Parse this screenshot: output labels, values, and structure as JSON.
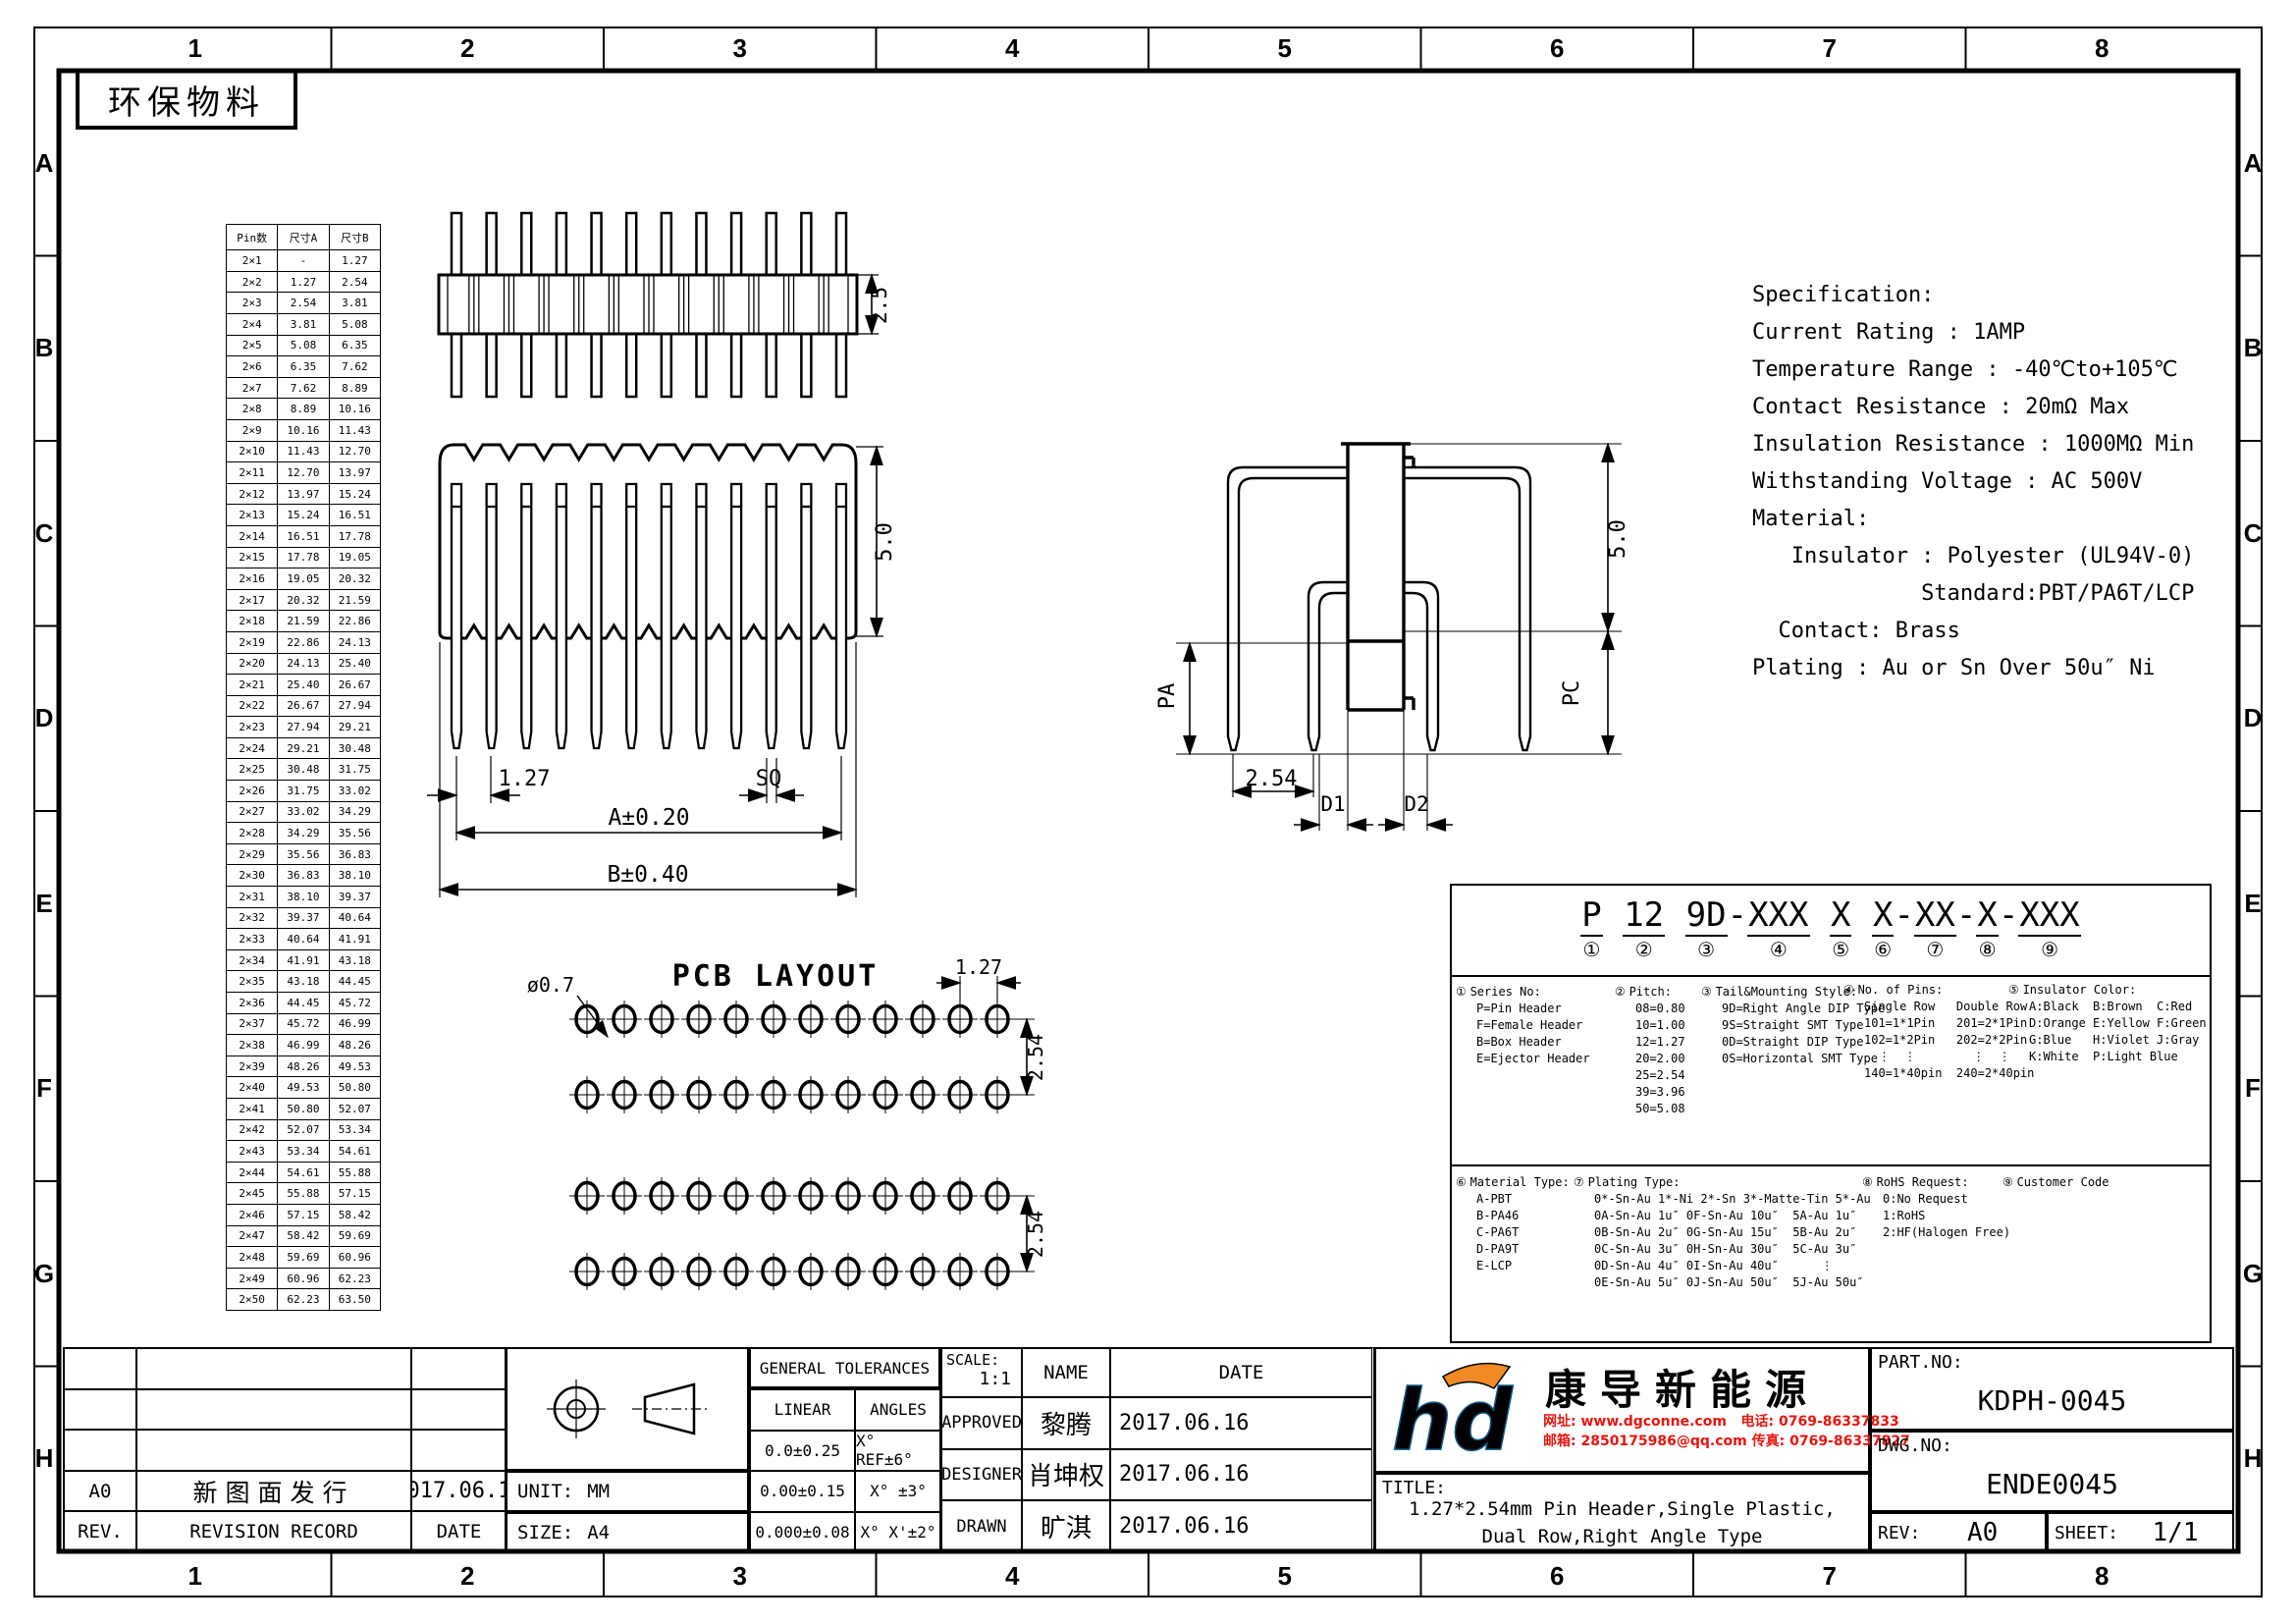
{
  "sheet": {
    "eco_label": "环保物料",
    "col_labels": [
      "1",
      "2",
      "3",
      "4",
      "5",
      "6",
      "7",
      "8"
    ],
    "row_labels": [
      "A",
      "B",
      "C",
      "D",
      "E",
      "F",
      "G",
      "H"
    ]
  },
  "pin_table": {
    "headers": [
      "Pin数",
      "尺寸A",
      "尺寸B"
    ],
    "rows": [
      [
        "2×1",
        "-",
        "1.27"
      ],
      [
        "2×2",
        "1.27",
        "2.54"
      ],
      [
        "2×3",
        "2.54",
        "3.81"
      ],
      [
        "2×4",
        "3.81",
        "5.08"
      ],
      [
        "2×5",
        "5.08",
        "6.35"
      ],
      [
        "2×6",
        "6.35",
        "7.62"
      ],
      [
        "2×7",
        "7.62",
        "8.89"
      ],
      [
        "2×8",
        "8.89",
        "10.16"
      ],
      [
        "2×9",
        "10.16",
        "11.43"
      ],
      [
        "2×10",
        "11.43",
        "12.70"
      ],
      [
        "2×11",
        "12.70",
        "13.97"
      ],
      [
        "2×12",
        "13.97",
        "15.24"
      ],
      [
        "2×13",
        "15.24",
        "16.51"
      ],
      [
        "2×14",
        "16.51",
        "17.78"
      ],
      [
        "2×15",
        "17.78",
        "19.05"
      ],
      [
        "2×16",
        "19.05",
        "20.32"
      ],
      [
        "2×17",
        "20.32",
        "21.59"
      ],
      [
        "2×18",
        "21.59",
        "22.86"
      ],
      [
        "2×19",
        "22.86",
        "24.13"
      ],
      [
        "2×20",
        "24.13",
        "25.40"
      ],
      [
        "2×21",
        "25.40",
        "26.67"
      ],
      [
        "2×22",
        "26.67",
        "27.94"
      ],
      [
        "2×23",
        "27.94",
        "29.21"
      ],
      [
        "2×24",
        "29.21",
        "30.48"
      ],
      [
        "2×25",
        "30.48",
        "31.75"
      ],
      [
        "2×26",
        "31.75",
        "33.02"
      ],
      [
        "2×27",
        "33.02",
        "34.29"
      ],
      [
        "2×28",
        "34.29",
        "35.56"
      ],
      [
        "2×29",
        "35.56",
        "36.83"
      ],
      [
        "2×30",
        "36.83",
        "38.10"
      ],
      [
        "2×31",
        "38.10",
        "39.37"
      ],
      [
        "2×32",
        "39.37",
        "40.64"
      ],
      [
        "2×33",
        "40.64",
        "41.91"
      ],
      [
        "2×34",
        "41.91",
        "43.18"
      ],
      [
        "2×35",
        "43.18",
        "44.45"
      ],
      [
        "2×36",
        "44.45",
        "45.72"
      ],
      [
        "2×37",
        "45.72",
        "46.99"
      ],
      [
        "2×38",
        "46.99",
        "48.26"
      ],
      [
        "2×39",
        "48.26",
        "49.53"
      ],
      [
        "2×40",
        "49.53",
        "50.80"
      ],
      [
        "2×41",
        "50.80",
        "52.07"
      ],
      [
        "2×42",
        "52.07",
        "53.34"
      ],
      [
        "2×43",
        "53.34",
        "54.61"
      ],
      [
        "2×44",
        "54.61",
        "55.88"
      ],
      [
        "2×45",
        "55.88",
        "57.15"
      ],
      [
        "2×46",
        "57.15",
        "58.42"
      ],
      [
        "2×47",
        "58.42",
        "59.69"
      ],
      [
        "2×48",
        "59.69",
        "60.96"
      ],
      [
        "2×49",
        "60.96",
        "62.23"
      ],
      [
        "2×50",
        "62.23",
        "63.50"
      ]
    ]
  },
  "spec": {
    "lines": [
      "Specification:",
      "Current Rating : 1AMP",
      "Temperature Range : -40℃to+105℃",
      "Contact Resistance : 20mΩ Max",
      "Insulation Resistance : 1000MΩ Min",
      "Withstanding Voltage : AC 500V",
      "Material:",
      "   Insulator : Polyester (UL94V-0)",
      "             Standard:PBT/PA6T/LCP",
      "  Contact: Brass",
      "Plating : Au or Sn Over 50u″ Ni"
    ]
  },
  "views": {
    "top": {
      "pin_count": 12,
      "dim_height": "2.5"
    },
    "front": {
      "pin_count": 12,
      "dim_h": "5.0",
      "dim_pitch": "1.27",
      "dim_sq": "SQ",
      "dim_a": "A±0.20",
      "dim_b": "B±0.40"
    },
    "side": {
      "dim_h": "5.0",
      "dim_pa": "PA",
      "dim_pc": "PC",
      "dim_pitch": "2.54",
      "dim_d1": "D1",
      "dim_d2": "D2"
    },
    "pcb": {
      "title": "PCB LAYOUT",
      "hole_label": "ø0.7",
      "cols": 12,
      "rows": 4,
      "dim_pitch": "1.27",
      "dim_row_top": "2.54",
      "dim_row_bottom": "2.54"
    }
  },
  "part_code": {
    "segments": [
      {
        "text": "P",
        "num": "①"
      },
      {
        "text": "12",
        "num": "②"
      },
      {
        "text": "9D",
        "num": "③"
      },
      {
        "text": "XXX",
        "num": "④"
      },
      {
        "text": "X",
        "num": "⑤"
      },
      {
        "text": "X",
        "num": "⑥"
      },
      {
        "text": "XX",
        "num": "⑦"
      },
      {
        "text": "X",
        "num": "⑧"
      },
      {
        "text": "XXX",
        "num": "⑨"
      }
    ],
    "separators": [
      "",
      " ",
      " ",
      "-",
      " ",
      " ",
      "-",
      "-",
      "-"
    ],
    "sections_top": [
      {
        "num": "①",
        "title": "Series No:",
        "lines": [
          "P=Pin Header",
          "F=Female Header",
          "B=Box Header",
          "E=Ejector Header"
        ]
      },
      {
        "num": "②",
        "title": "Pitch:",
        "lines": [
          "08=0.80",
          "10=1.00",
          "12=1.27",
          "20=2.00",
          "25=2.54",
          "39=3.96",
          "50=5.08"
        ]
      },
      {
        "num": "③",
        "title": "Tail&Mounting Style:",
        "lines": [
          "9D=Right Angle DIP Type",
          "9S=Straight SMT Type",
          "0D=Straight DIP Type",
          "0S=Horizontal SMT Type"
        ]
      },
      {
        "num": "④",
        "title": "No. of Pins:",
        "lines": [
          "Single Row   Double Row",
          "101=1*1Pin   201=2*1Pin",
          "102=1*2Pin   202=2*2Pin",
          "  ⋮  ⋮        ⋮  ⋮",
          "140=1*40pin  240=2*40pin"
        ]
      },
      {
        "num": "⑤",
        "title": "Insulator Color:",
        "lines": [
          "A:Black  B:Brown  C:Red",
          "D:Orange E:Yellow F:Green",
          "G:Blue   H:Violet J:Gray",
          "K:White  P:Light Blue"
        ]
      }
    ],
    "sections_bottom": [
      {
        "num": "⑥",
        "title": "Material Type:",
        "lines": [
          "A-PBT",
          "B-PA46",
          "C-PA6T",
          "D-PA9T",
          "E-LCP"
        ]
      },
      {
        "num": "⑦",
        "title": "Plating Type:",
        "lines": [
          "0*-Sn-Au 1*-Ni 2*-Sn 3*-Matte-Tin 5*-Au",
          "0A-Sn-Au 1u″ 0F-Sn-Au 10u″  5A-Au 1u″",
          "0B-Sn-Au 2u″ 0G-Sn-Au 15u″  5B-Au 2u″",
          "0C-Sn-Au 3u″ 0H-Sn-Au 30u″  5C-Au 3u″",
          "0D-Sn-Au 4u″ 0I-Sn-Au 40u″      ⋮",
          "0E-Sn-Au 5u″ 0J-Sn-Au 50u″  5J-Au 50u″"
        ]
      },
      {
        "num": "⑧",
        "title": "RoHS Request:",
        "lines": [
          "0:No Request",
          "1:RoHS",
          "2:HF(Halogen Free)"
        ]
      },
      {
        "num": "⑨",
        "title": "Customer Code",
        "lines": []
      }
    ]
  },
  "title_block": {
    "revision": {
      "rev_value": "A0",
      "record_value": "新图面发行",
      "date_value": "2017.06.16",
      "rev_label": "REV.",
      "record_label": "REVISION RECORD",
      "date_label": "DATE"
    },
    "unit_label": "UNIT:",
    "unit_value": "MM",
    "size_label": "SIZE:",
    "size_value": "A4",
    "tolerances": {
      "title": "GENERAL TOLERANCES",
      "linear": "LINEAR",
      "angles": "ANGLES",
      "rows": [
        [
          "0.0±0.25",
          "X° REF±6°"
        ],
        [
          "0.00±0.15",
          "X° ±3°"
        ],
        [
          "0.000±0.08",
          "X° X'±2°"
        ]
      ]
    },
    "scale_label": "SCALE:",
    "scale_value": "1:1",
    "name_label": "NAME",
    "date_label": "DATE",
    "approvals": [
      {
        "role": "APPROVED",
        "name": "黎腾",
        "date": "2017.06.16"
      },
      {
        "role": "DESIGNER",
        "name": "肖坤权",
        "date": "2017.06.16"
      },
      {
        "role": "DRAWN",
        "name": "旷淇",
        "date": "2017.06.16"
      }
    ],
    "company": {
      "logo": "hd",
      "name": "康导新能源",
      "contact_line1": "网址: www.dgconne.com   电话: 0769-86337833",
      "contact_line2": "邮箱: 2850175986@qq.com 传真: 0769-86337827"
    },
    "title_label": "TITLE:",
    "title_line1": "1.27*2.54mm Pin Header,Single Plastic,",
    "title_line2": "Dual Row,Right Angle Type",
    "part_no_label": "PART.NO:",
    "part_no": "KDPH-0045",
    "dwg_no_label": "DWG.NO:",
    "dwg_no": "ENDE0045",
    "rev_label": "REV:",
    "rev": "A0",
    "sheet_label": "SHEET:",
    "sheet": "1/1"
  },
  "colors": {
    "line": "#000000",
    "contact_red": "#e8150d",
    "logo_blue": "#2aa9e0",
    "logo_orange": "#f08a24"
  }
}
